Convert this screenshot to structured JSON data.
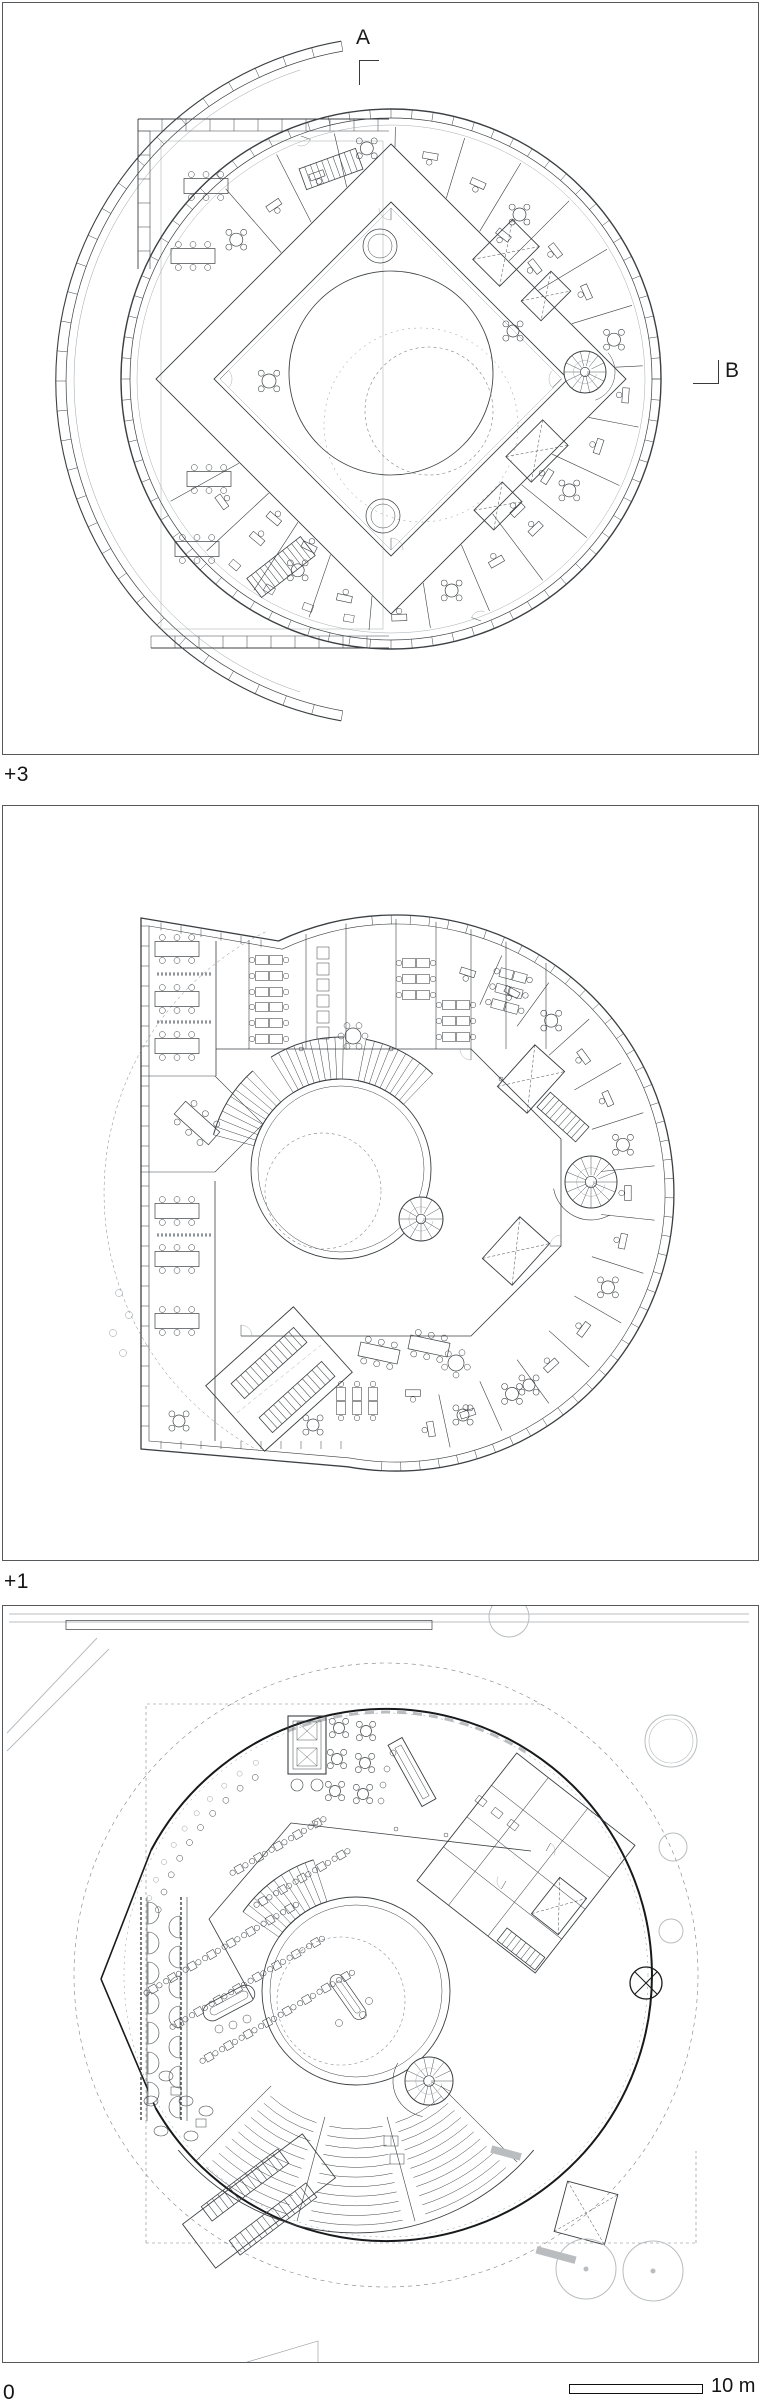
{
  "drawing": {
    "section_markers": {
      "a": "A",
      "b": "B"
    },
    "levels": [
      {
        "label": "+3"
      },
      {
        "label": "+1"
      },
      {
        "label": "0"
      }
    ],
    "scale": {
      "label": "10 m"
    }
  },
  "colors": {
    "ink": "#3c4043",
    "ink_heavy": "#17191b",
    "ink_light": "#8f959a",
    "gray": "#b9bdbf",
    "dash": "#7d8388",
    "frame": "#56595c",
    "label": "#141414",
    "background": "#ffffff"
  }
}
